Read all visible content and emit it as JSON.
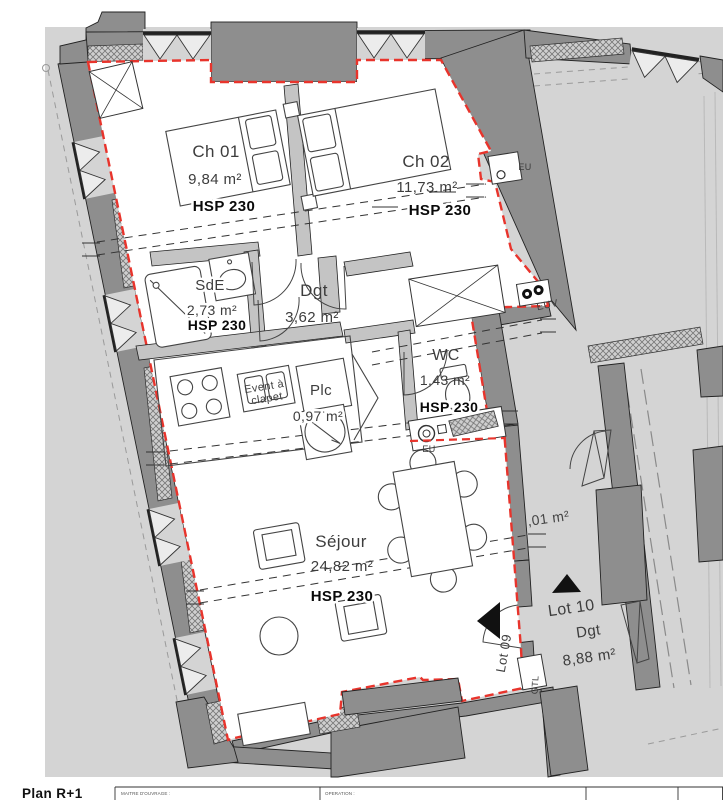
{
  "plan": {
    "rooms": {
      "ch01": {
        "name": "Ch 01",
        "area": "9,84 m²",
        "hsp": "HSP 230"
      },
      "ch02": {
        "name": "Ch 02",
        "area": "11,73 m²",
        "hsp": "HSP 230"
      },
      "sde": {
        "name": "SdE",
        "area": "2,73 m²",
        "hsp": "HSP 230"
      },
      "dgt": {
        "name": "Dgt",
        "area": "3,62 m²"
      },
      "wc": {
        "name": "WC",
        "area": "1,43 m²",
        "hsp": "HSP 230"
      },
      "plc": {
        "name": "Plc",
        "area": "0,97 m²"
      },
      "sejour": {
        "name": "Séjour",
        "area": "24,82 m²",
        "hsp": "HSP 230"
      }
    },
    "lot10": {
      "name": "Lot 10",
      "room": "Dgt",
      "area": "8,88 m²"
    },
    "lot09_label": "Lot 09",
    "annotations": {
      "eu_top": "EU",
      "eu_wc": "EU",
      "euv": "EUV",
      "vent_line1": "Event à",
      "vent_line2": "clapet",
      "gtl": "GTL",
      "partial_area": ",01 m²"
    }
  },
  "footer": {
    "plan_label": "Plan R+1",
    "titleblock": {
      "col1": "MAITRE D'OUVRAGE :",
      "col2": "OPERATION :"
    }
  },
  "colors": {
    "boundary_red": "#e8342c",
    "wall_gray": "#8e8e8e",
    "bg_gray": "#d4d4d4"
  }
}
